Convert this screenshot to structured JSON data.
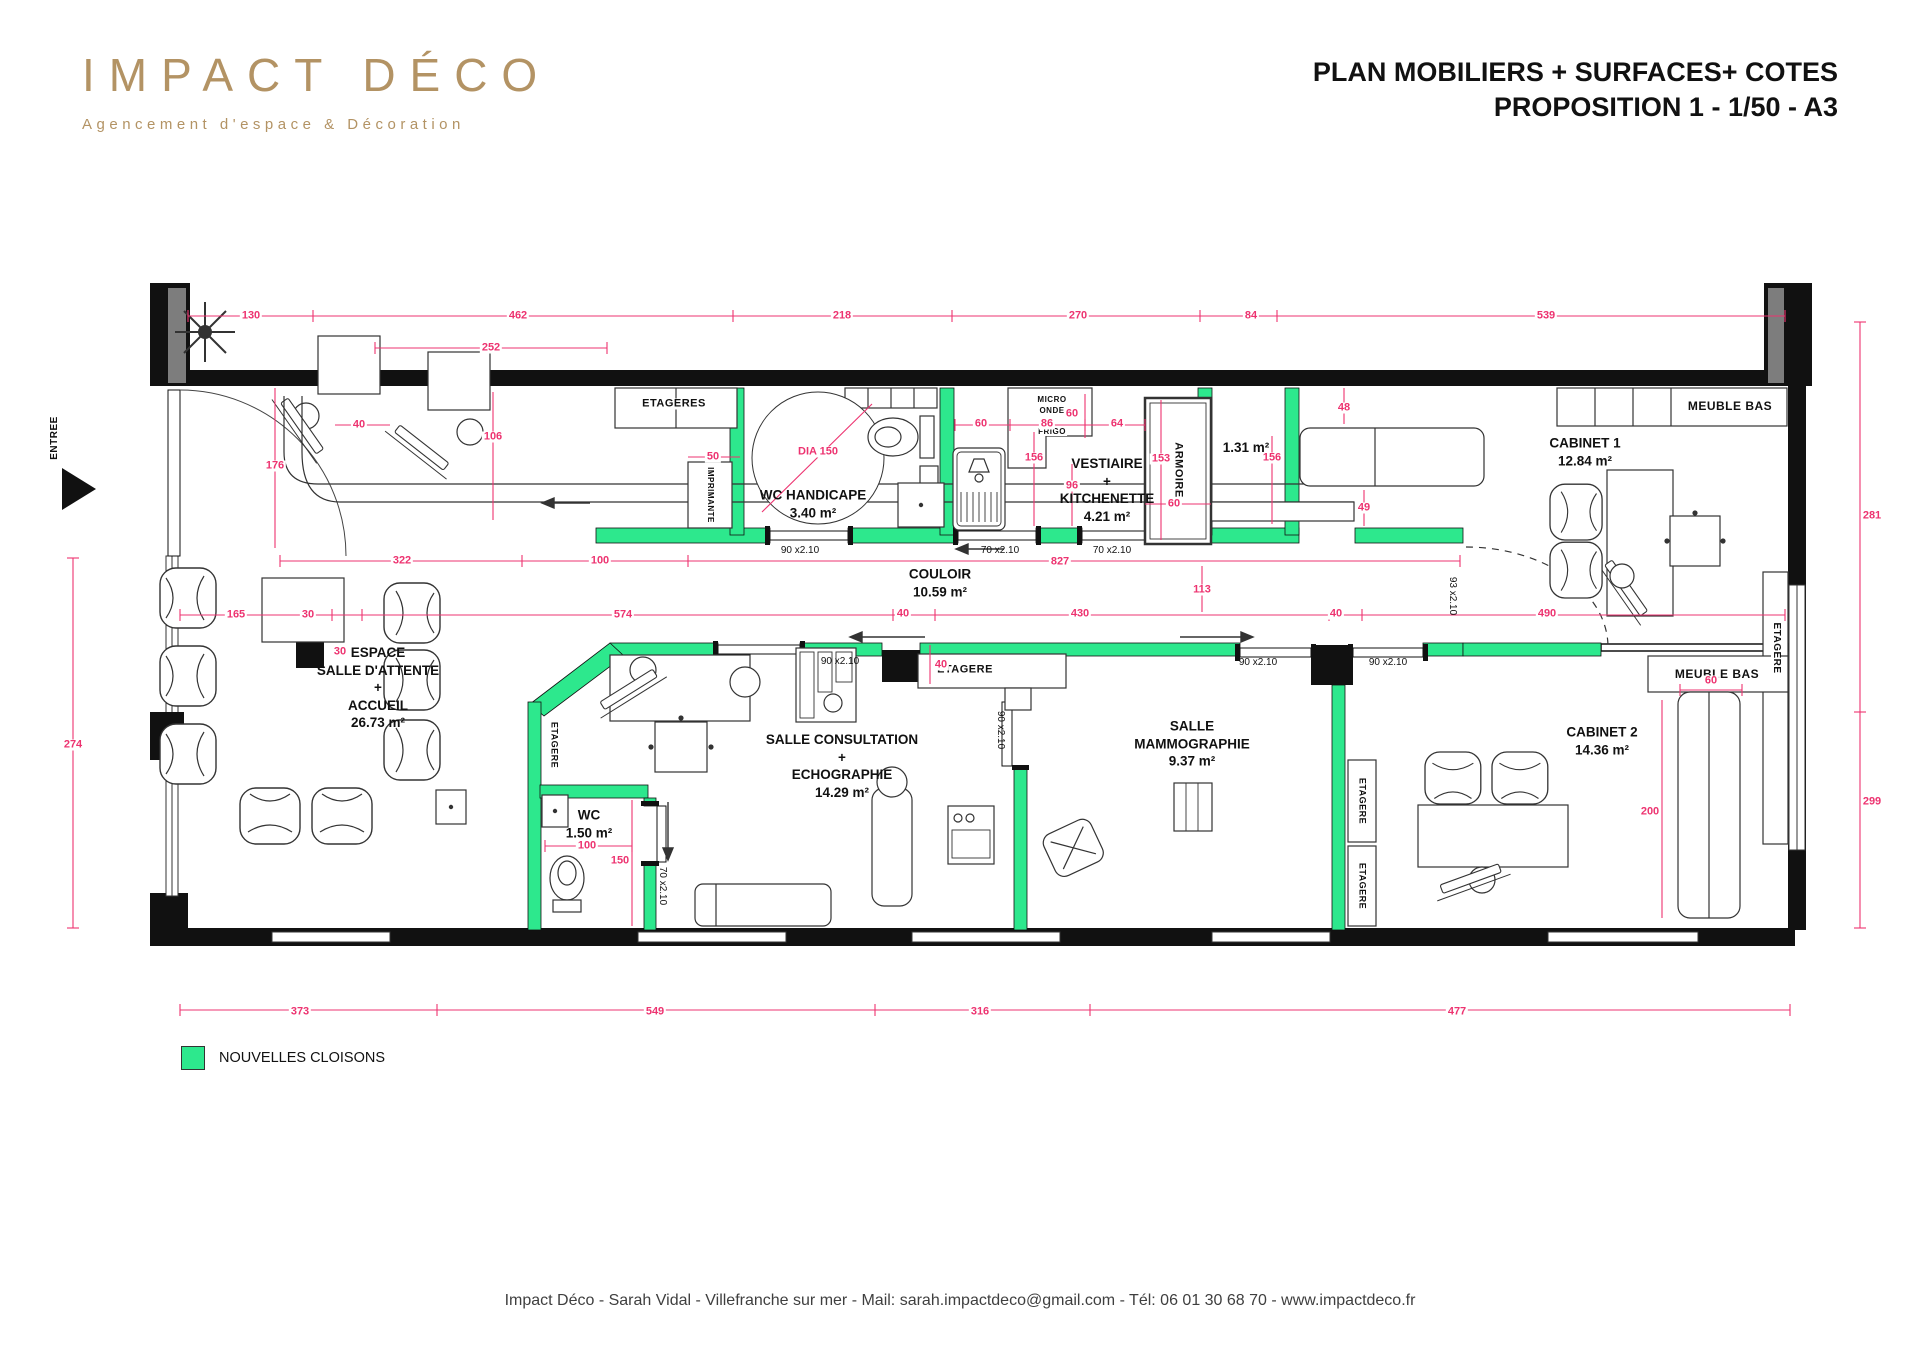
{
  "header": {
    "logo_title": "IMPACT DÉCO",
    "logo_subtitle": "Agencement d'espace & Décoration",
    "title_line1": "PLAN MOBILIERS + SURFACES+ COTES",
    "title_line2": "PROPOSITION 1 - 1/50 - A3"
  },
  "legend": {
    "label": "NOUVELLES CLOISONS"
  },
  "footer": {
    "text": "Impact Déco - Sarah Vidal - Villefranche sur mer -  Mail: sarah.impactdeco@gmail.com - Tél: 06 01 30 68 70 - www.impactdeco.fr"
  },
  "colors": {
    "dimension_pink": "#ED3370",
    "new_wall_green": "#2DE88D",
    "wall_black": "#111111",
    "logo_tan": "#B39364"
  },
  "plan": {
    "rooms": [
      {
        "id": "salle-attente",
        "x": 378,
        "y": 688,
        "lines": [
          "ESPACE",
          "SALLE D'ATTENTE",
          "+",
          "ACCUEIL",
          "26.73 m²"
        ]
      },
      {
        "id": "wc-handicape",
        "x": 813,
        "y": 504,
        "lines": [
          "WC HANDICAPE",
          "3.40 m²"
        ]
      },
      {
        "id": "couloir",
        "x": 940,
        "y": 583,
        "lines": [
          "COULOIR",
          "10.59 m²"
        ]
      },
      {
        "id": "vestiaire-kitchenette",
        "x": 1107,
        "y": 490,
        "lines": [
          "VESTIAIRE",
          "+",
          "KITCHENETTE",
          "4.21 m²"
        ]
      },
      {
        "id": "reserve",
        "x": 1246,
        "y": 448,
        "lines": [
          "1.31 m²"
        ]
      },
      {
        "id": "cabinet-1",
        "x": 1585,
        "y": 452,
        "lines": [
          "CABINET 1",
          "12.84 m²"
        ]
      },
      {
        "id": "salle-consultation",
        "x": 842,
        "y": 766,
        "lines": [
          "SALLE CONSULTATION",
          "+",
          "ECHOGRAPHIE",
          "14.29 m²"
        ]
      },
      {
        "id": "salle-mammographie",
        "x": 1192,
        "y": 744,
        "lines": [
          "SALLE",
          "MAMMOGRAPHIE",
          "9.37 m²"
        ]
      },
      {
        "id": "cabinet-2",
        "x": 1602,
        "y": 741,
        "lines": [
          "CABINET 2",
          "14.36 m²"
        ]
      },
      {
        "id": "wc",
        "x": 589,
        "y": 824,
        "lines": [
          "WC",
          "1.50 m²"
        ]
      }
    ],
    "features": [
      {
        "t": "ETAGERES",
        "x": 674,
        "y": 404,
        "size": 11
      },
      {
        "t": "IMPRIMANTE",
        "x": 710,
        "y": 495,
        "size": 8,
        "rot": 90
      },
      {
        "t": "MICRO",
        "x": 1052,
        "y": 400,
        "size": 8
      },
      {
        "t": "ONDE",
        "x": 1052,
        "y": 411,
        "size": 8
      },
      {
        "t": "FRIGO",
        "x": 1052,
        "y": 432,
        "size": 8
      },
      {
        "t": "ARMOIRE",
        "x": 1178,
        "y": 470,
        "size": 11,
        "rot": 90
      },
      {
        "t": "MEUBLE BAS",
        "x": 1730,
        "y": 406,
        "size": 12
      },
      {
        "t": "MEUBLE BAS",
        "x": 1717,
        "y": 674,
        "size": 12
      },
      {
        "t": "ETAGERE",
        "x": 965,
        "y": 670,
        "size": 11
      },
      {
        "t": "ETAGERE",
        "x": 554,
        "y": 745,
        "size": 9,
        "rot": 90
      },
      {
        "t": "ETAGERE",
        "x": 1362,
        "y": 801,
        "size": 9,
        "rot": 90
      },
      {
        "t": "ETAGERE",
        "x": 1362,
        "y": 886,
        "size": 9,
        "rot": 90
      },
      {
        "t": "ETAGERE",
        "x": 1776,
        "y": 648,
        "size": 10,
        "rot": 90
      },
      {
        "t": "ENTREE",
        "x": 55,
        "y": 438,
        "size": 10,
        "rot": -90
      }
    ],
    "doors": [
      {
        "t": "90 x2.10",
        "x": 800,
        "y": 551
      },
      {
        "t": "70 x2.10",
        "x": 1000,
        "y": 551
      },
      {
        "t": "70 x2.10",
        "x": 1112,
        "y": 551
      },
      {
        "t": "90 x2.10",
        "x": 840,
        "y": 662
      },
      {
        "t": "90 x2.10",
        "x": 1258,
        "y": 663
      },
      {
        "t": "90 x2.10",
        "x": 1388,
        "y": 663
      },
      {
        "t": "90 x2.10",
        "x": 1000,
        "y": 730,
        "rot": 90
      },
      {
        "t": "93 x2.10",
        "x": 1452,
        "y": 596,
        "rot": 90
      },
      {
        "t": "70 x2.10",
        "x": 662,
        "y": 886,
        "rot": 90
      }
    ],
    "dims": [
      {
        "t": "130",
        "x": 251,
        "y": 316
      },
      {
        "t": "462",
        "x": 518,
        "y": 316
      },
      {
        "t": "218",
        "x": 842,
        "y": 316
      },
      {
        "t": "270",
        "x": 1078,
        "y": 316
      },
      {
        "t": "84",
        "x": 1251,
        "y": 316
      },
      {
        "t": "539",
        "x": 1546,
        "y": 316
      },
      {
        "t": "252",
        "x": 491,
        "y": 348
      },
      {
        "t": "176",
        "x": 275,
        "y": 466
      },
      {
        "t": "40",
        "x": 359,
        "y": 425
      },
      {
        "t": "106",
        "x": 493,
        "y": 437
      },
      {
        "t": "50",
        "x": 713,
        "y": 457
      },
      {
        "t": "DIA 150",
        "x": 818,
        "y": 452
      },
      {
        "t": "60",
        "x": 981,
        "y": 424
      },
      {
        "t": "86",
        "x": 1047,
        "y": 424
      },
      {
        "t": "64",
        "x": 1117,
        "y": 424
      },
      {
        "t": "60",
        "x": 1072,
        "y": 414
      },
      {
        "t": "156",
        "x": 1034,
        "y": 458
      },
      {
        "t": "96",
        "x": 1072,
        "y": 486
      },
      {
        "t": "153",
        "x": 1161,
        "y": 459
      },
      {
        "t": "60",
        "x": 1174,
        "y": 504
      },
      {
        "t": "156",
        "x": 1272,
        "y": 458
      },
      {
        "t": "48",
        "x": 1344,
        "y": 408
      },
      {
        "t": "49",
        "x": 1364,
        "y": 508
      },
      {
        "t": "281",
        "x": 1872,
        "y": 516
      },
      {
        "t": "165",
        "x": 236,
        "y": 615
      },
      {
        "t": "30",
        "x": 308,
        "y": 615
      },
      {
        "t": "574",
        "x": 623,
        "y": 615
      },
      {
        "t": "40",
        "x": 903,
        "y": 614
      },
      {
        "t": "430",
        "x": 1080,
        "y": 614
      },
      {
        "t": "113",
        "x": 1202,
        "y": 590
      },
      {
        "t": "40",
        "x": 1336,
        "y": 614
      },
      {
        "t": "490",
        "x": 1547,
        "y": 614
      },
      {
        "t": "30",
        "x": 340,
        "y": 652
      },
      {
        "t": "40",
        "x": 941,
        "y": 665
      },
      {
        "t": "322",
        "x": 402,
        "y": 561
      },
      {
        "t": "100",
        "x": 600,
        "y": 561
      },
      {
        "t": "827",
        "x": 1060,
        "y": 562
      },
      {
        "t": "100",
        "x": 587,
        "y": 846
      },
      {
        "t": "150",
        "x": 620,
        "y": 861
      },
      {
        "t": "60",
        "x": 1711,
        "y": 681
      },
      {
        "t": "200",
        "x": 1650,
        "y": 812
      },
      {
        "t": "274",
        "x": 73,
        "y": 745
      },
      {
        "t": "299",
        "x": 1872,
        "y": 802
      },
      {
        "t": "373",
        "x": 300,
        "y": 1012
      },
      {
        "t": "549",
        "x": 655,
        "y": 1012
      },
      {
        "t": "316",
        "x": 980,
        "y": 1012
      },
      {
        "t": "477",
        "x": 1457,
        "y": 1012
      }
    ]
  }
}
